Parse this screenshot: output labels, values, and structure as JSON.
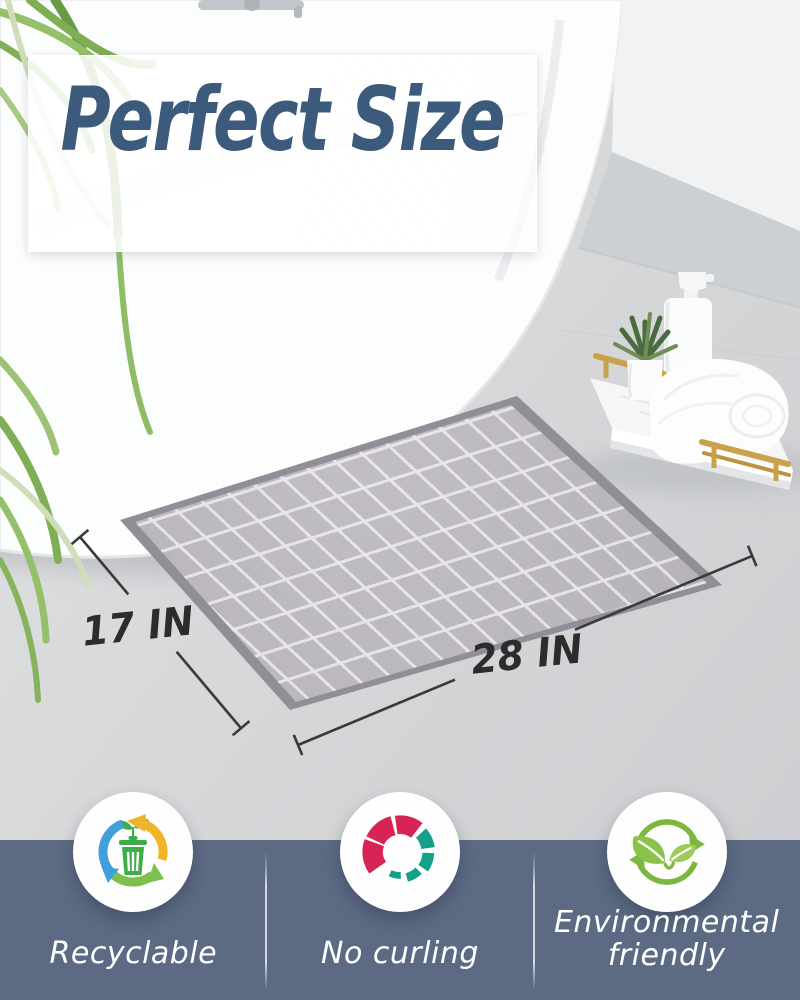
{
  "title": "Perfect Size",
  "dimension_labels": {
    "width": "28 IN",
    "depth": "17 IN"
  },
  "features": [
    {
      "label": "Recyclable",
      "icon": "recycle-bin-icon"
    },
    {
      "label": "No curling",
      "icon": "no-curl-icon"
    },
    {
      "label": "Environmental friendly",
      "icon": "eco-leaves-icon"
    }
  ],
  "colors": {
    "title_blue": "#3b5a7c",
    "panel_blue": "#5c6a84",
    "dimension_text": "#2c2c2c",
    "mat_border": "#918e97",
    "mat_field": "#b6b2b9",
    "recycle_green": "#3fae49",
    "arrow_blue": "#41a0d9",
    "arrow_yellow": "#f0b429",
    "arrow_green": "#7fbf4d",
    "curl_crimson": "#d62456",
    "curl_teal": "#15a08c",
    "eco_green": "#7cb83f",
    "tray_gold": "#c9a24b"
  }
}
